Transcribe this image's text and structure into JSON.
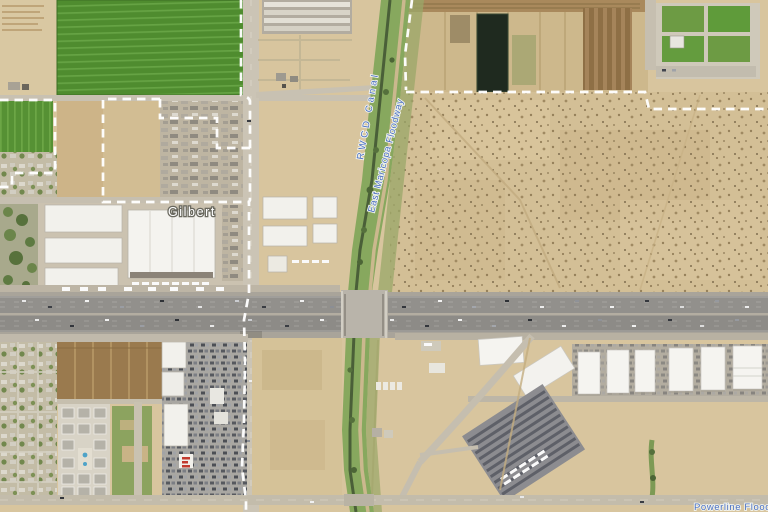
{
  "view": {
    "type": "satellite-map",
    "width_px": 768,
    "height_px": 512
  },
  "labels": {
    "city": "Gilbert",
    "canal": "RWCD Canal",
    "floodway": "East Maricopa Floodway",
    "powerline_floodway": "Powerline Floodway"
  },
  "label_styles": {
    "city_text_color": "#ffffff",
    "city_halo_color": "#6a695f",
    "water_text_color": "#4a6fc0",
    "boundary_dash_color": "#ffffff"
  },
  "terrain_palette": {
    "farmland_green": "#4f8c2f",
    "desert_tan": "#d8c59e",
    "freeway_asphalt": "#8f8d89",
    "canal_vegetation": "#7ca255",
    "pond_dark": "#1f2a1f"
  }
}
